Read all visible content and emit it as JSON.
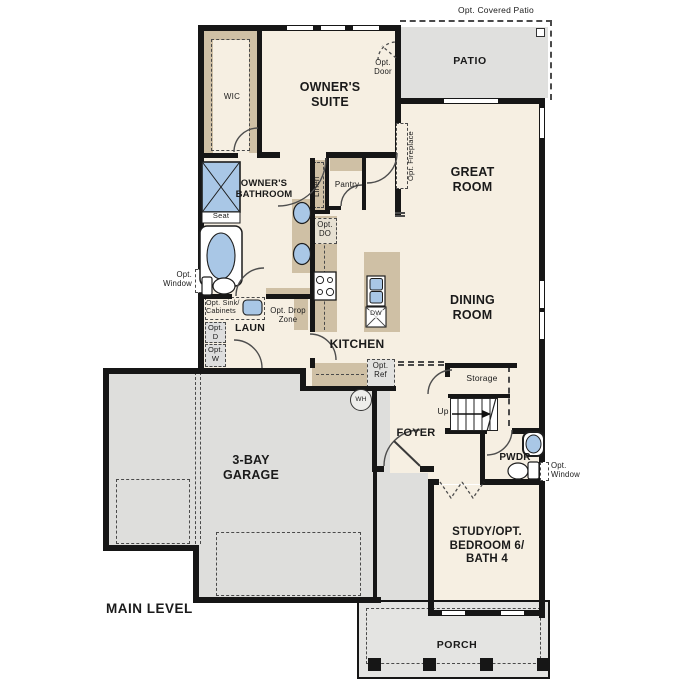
{
  "plan": {
    "level_label": "MAIN LEVEL",
    "rooms": {
      "patio": "PATIO",
      "wic": "WIC",
      "owners_suite": "OWNER'S\nSUITE",
      "great_room": "GREAT\nROOM",
      "owners_bathroom": "OWNER'S\nBATHROOM",
      "dining_room": "DINING\nROOM",
      "kitchen": "KITCHEN",
      "laundry": "LAUN",
      "garage": "3-BAY\nGARAGE",
      "foyer": "FOYER",
      "powder": "PWDR",
      "study": "STUDY/OPT.\nBEDROOM 6/\nBATH 4",
      "porch": "PORCH",
      "storage": "Storage",
      "pantry": "Pantry",
      "linen": "Linen"
    },
    "annotations": {
      "opt_covered_patio": "Opt. Covered Patio",
      "opt_door": "Opt.\nDoor",
      "opt_fireplace": "Opt. Fireplace",
      "opt_window": "Opt.\nWindow",
      "seat": "Seat",
      "opt_do": "Opt.\nDO",
      "opt_sink_cabinets": "Opt. Sink/\nCabinets",
      "opt_dryer": "Opt.\nD",
      "opt_washer": "Opt.\nW",
      "opt_drop_zone": "Opt. Drop\nZone",
      "opt_ref": "Opt.\nRef",
      "up": "Up"
    },
    "fixtures": {
      "dishwasher": "DW",
      "water_heater": "WH"
    },
    "colors": {
      "floor_cream": "#f6efe2",
      "floor_gray": "#e1e1de",
      "casework_tan": "#cfc0a5",
      "fixture_blue": "#a9c7e6",
      "wall_black": "#161616"
    }
  }
}
